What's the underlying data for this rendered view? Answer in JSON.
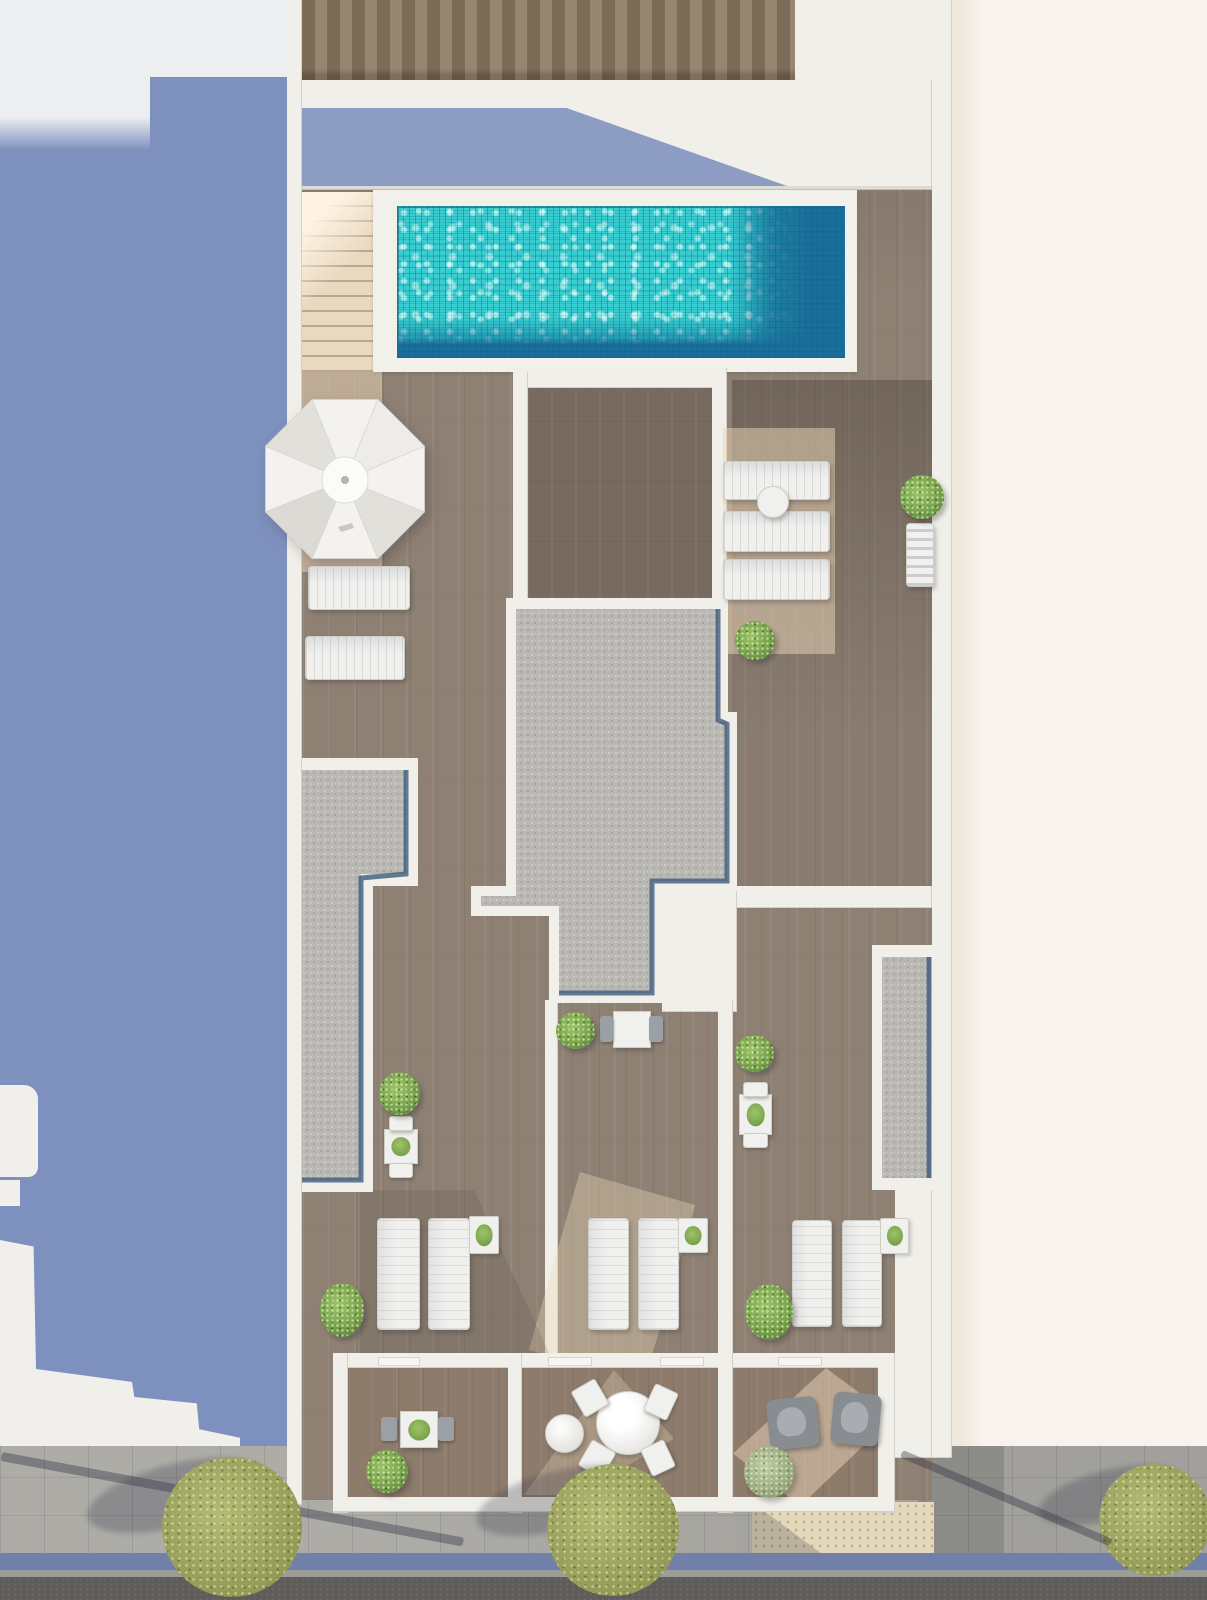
{
  "meta": {
    "title": "Aerial top-down 3D render — rooftop terraces of a residential building with swimming pool, sun deck, gravel roof sections, private balconies and street with trees",
    "type": "architectural-visualization",
    "visible_text": "none"
  },
  "colors": {
    "bgLeft": "#7e90bd",
    "bgLeftLight": "#eceef0",
    "bgLeftLit": "#f0efeb",
    "bgRight": "#f8f4ed",
    "bgRightShade": "#efe8dc",
    "wallWhite": "#f1efe9",
    "woodFence": "#8a7862",
    "woodBase": "#8e8174",
    "woodDark": "#776a5e",
    "woodBalcony": "#8d7b6c",
    "stairBeige": "#ead9c1",
    "poolShallow": "#38cdd0",
    "poolDeep": "#196f99",
    "copingWhite": "#f2f0ea",
    "gravel": "#bab8b3",
    "gravelDot1": "#cfcdc9",
    "gravelDot2": "#a3a19c",
    "gravelEdge": "#3d5c7c",
    "shadowBand": "#8c9cc3",
    "umbrella": "#f3f2ef",
    "umbrellaShade": "#e2e0db",
    "furnWhite": "#f0f0ee",
    "furnBorder": "#cfcdc7",
    "chairGray": "#9aa0a5",
    "armGray": "#888d92",
    "plantGreen": "#79a24c",
    "plantDark": "#55803a",
    "plantSage": "#9aab80",
    "treeOlive": "#b5ba73",
    "treeOliveDark": "#939a55",
    "sidewalk": "#a8a7a2",
    "tactile": "#e5d9bd",
    "tactileDot": "#c5b48d",
    "curbBlue": "#7080a8",
    "curbStone": "#9d9d98",
    "asphalt": "#5e5d5b"
  },
  "scene": {
    "regions": [
      "left-neighbor-building-in-shadow",
      "right-neighbor-building-cream",
      "rooftop-pool-terrace",
      "sun-deck-with-parasol",
      "gravel-roof-core",
      "three-middle-terraces-with-loungers",
      "three-street-balconies",
      "sidewalk-with-trees",
      "road"
    ],
    "furniture": [
      {
        "type": "lounger-h",
        "name": "sun-lounger",
        "x": 308,
        "y": 566,
        "w": 100,
        "h": 42
      },
      {
        "type": "lounger-h",
        "name": "sun-lounger",
        "x": 305,
        "y": 636,
        "w": 98,
        "h": 42
      },
      {
        "type": "lounger-h",
        "name": "sun-lounger",
        "x": 723,
        "y": 461,
        "w": 105,
        "h": 37
      },
      {
        "type": "lounger-h",
        "name": "sun-lounger",
        "x": 723,
        "y": 511,
        "w": 105,
        "h": 39
      },
      {
        "type": "lounger-h",
        "name": "sun-lounger",
        "x": 723,
        "y": 559,
        "w": 105,
        "h": 39
      },
      {
        "type": "sidetable-round",
        "name": "round-side-table",
        "x": 757,
        "y": 486,
        "w": 30,
        "h": 30
      },
      {
        "type": "lounger-v towel",
        "name": "lounger-with-towel",
        "x": 906,
        "y": 523,
        "w": 26,
        "h": 62
      },
      {
        "type": "lounger-v",
        "name": "sun-lounger",
        "x": 377,
        "y": 1218,
        "w": 41,
        "h": 110
      },
      {
        "type": "lounger-v",
        "name": "sun-lounger",
        "x": 428,
        "y": 1218,
        "w": 40,
        "h": 110
      },
      {
        "type": "lounger-v",
        "name": "sun-lounger",
        "x": 588,
        "y": 1218,
        "w": 39,
        "h": 110
      },
      {
        "type": "lounger-v",
        "name": "sun-lounger",
        "x": 638,
        "y": 1218,
        "w": 39,
        "h": 110
      },
      {
        "type": "lounger-v",
        "name": "sun-lounger",
        "x": 792,
        "y": 1220,
        "w": 38,
        "h": 105
      },
      {
        "type": "lounger-v",
        "name": "sun-lounger",
        "x": 842,
        "y": 1220,
        "w": 38,
        "h": 105
      },
      {
        "type": "sidetable plant-on",
        "name": "side-table-with-plant",
        "x": 469,
        "y": 1216,
        "w": 28,
        "h": 36
      },
      {
        "type": "sidetable plant-on",
        "name": "side-table-with-plant",
        "x": 678,
        "y": 1218,
        "w": 28,
        "h": 33
      },
      {
        "type": "sidetable plant-on",
        "name": "side-table-with-plant",
        "x": 880,
        "y": 1218,
        "w": 27,
        "h": 34
      },
      {
        "type": "table-sq",
        "name": "dining-table",
        "x": 613,
        "y": 1011,
        "w": 36,
        "h": 35
      },
      {
        "type": "chair",
        "name": "chair",
        "x": 600,
        "y": 1016,
        "w": 13,
        "h": 26
      },
      {
        "type": "chair",
        "name": "chair",
        "x": 649,
        "y": 1016,
        "w": 14,
        "h": 26
      },
      {
        "type": "table-sq plant-on",
        "name": "dining-table",
        "x": 739,
        "y": 1094,
        "w": 31,
        "h": 39
      },
      {
        "type": "chair-white",
        "name": "chair",
        "x": 743,
        "y": 1082,
        "w": 23,
        "h": 13
      },
      {
        "type": "chair-white",
        "name": "chair",
        "x": 743,
        "y": 1133,
        "w": 23,
        "h": 13
      },
      {
        "type": "table-sq plant-on",
        "name": "dining-table",
        "x": 384,
        "y": 1129,
        "w": 32,
        "h": 33
      },
      {
        "type": "chair-white",
        "name": "chair",
        "x": 389,
        "y": 1116,
        "w": 22,
        "h": 13
      },
      {
        "type": "chair-white",
        "name": "chair",
        "x": 389,
        "y": 1163,
        "w": 22,
        "h": 13
      },
      {
        "type": "table-sq plant-on",
        "name": "balcony-table",
        "x": 400,
        "y": 1411,
        "w": 36,
        "h": 35
      },
      {
        "type": "chair",
        "name": "chair",
        "x": 381,
        "y": 1417,
        "w": 16,
        "h": 24
      },
      {
        "type": "chair",
        "name": "chair",
        "x": 438,
        "y": 1417,
        "w": 16,
        "h": 24
      },
      {
        "type": "table-round",
        "name": "round-dining-table",
        "x": 596,
        "y": 1391,
        "w": 62,
        "h": 62
      },
      {
        "type": "chair-white",
        "name": "chair",
        "x": 576,
        "y": 1383,
        "w": 26,
        "h": 28,
        "rot": -30
      },
      {
        "type": "chair-white",
        "name": "chair",
        "x": 583,
        "y": 1444,
        "w": 26,
        "h": 28,
        "rot": 30
      },
      {
        "type": "chair-white",
        "name": "chair",
        "x": 648,
        "y": 1387,
        "w": 24,
        "h": 28,
        "rot": 25
      },
      {
        "type": "chair-white",
        "name": "chair",
        "x": 645,
        "y": 1443,
        "w": 24,
        "h": 28,
        "rot": -25
      },
      {
        "type": "pouf",
        "name": "pouf",
        "x": 545,
        "y": 1414,
        "w": 37,
        "h": 37
      },
      {
        "type": "armchair",
        "name": "armchair",
        "x": 768,
        "y": 1398,
        "w": 50,
        "h": 50,
        "rot": -6
      },
      {
        "type": "armchair",
        "name": "armchair",
        "x": 832,
        "y": 1393,
        "w": 48,
        "h": 52,
        "rot": 5
      },
      {
        "type": "plant",
        "name": "potted-plant",
        "x": 900,
        "y": 475,
        "w": 44,
        "h": 44
      },
      {
        "type": "plant",
        "name": "potted-plant",
        "x": 735,
        "y": 621,
        "w": 40,
        "h": 39
      },
      {
        "type": "plant",
        "name": "potted-plant",
        "x": 556,
        "y": 1012,
        "w": 39,
        "h": 37
      },
      {
        "type": "plant",
        "name": "potted-plant",
        "x": 735,
        "y": 1035,
        "w": 39,
        "h": 37
      },
      {
        "type": "plant",
        "name": "potted-plant",
        "x": 379,
        "y": 1072,
        "w": 41,
        "h": 43
      },
      {
        "type": "plant",
        "name": "potted-plant",
        "x": 320,
        "y": 1283,
        "w": 44,
        "h": 54
      },
      {
        "type": "plant",
        "name": "potted-plant",
        "x": 745,
        "y": 1284,
        "w": 48,
        "h": 56
      },
      {
        "type": "plant",
        "name": "potted-plant",
        "x": 366,
        "y": 1450,
        "w": 42,
        "h": 43
      },
      {
        "type": "plant-olive",
        "name": "potted-plant",
        "x": 744,
        "y": 1446,
        "w": 50,
        "h": 52
      }
    ],
    "street": {
      "trees": [
        {
          "cx": 232,
          "cy": 1527,
          "r": 70
        },
        {
          "cx": 613,
          "cy": 1530,
          "r": 66
        },
        {
          "cx": 1155,
          "cy": 1520,
          "r": 56
        }
      ]
    }
  }
}
